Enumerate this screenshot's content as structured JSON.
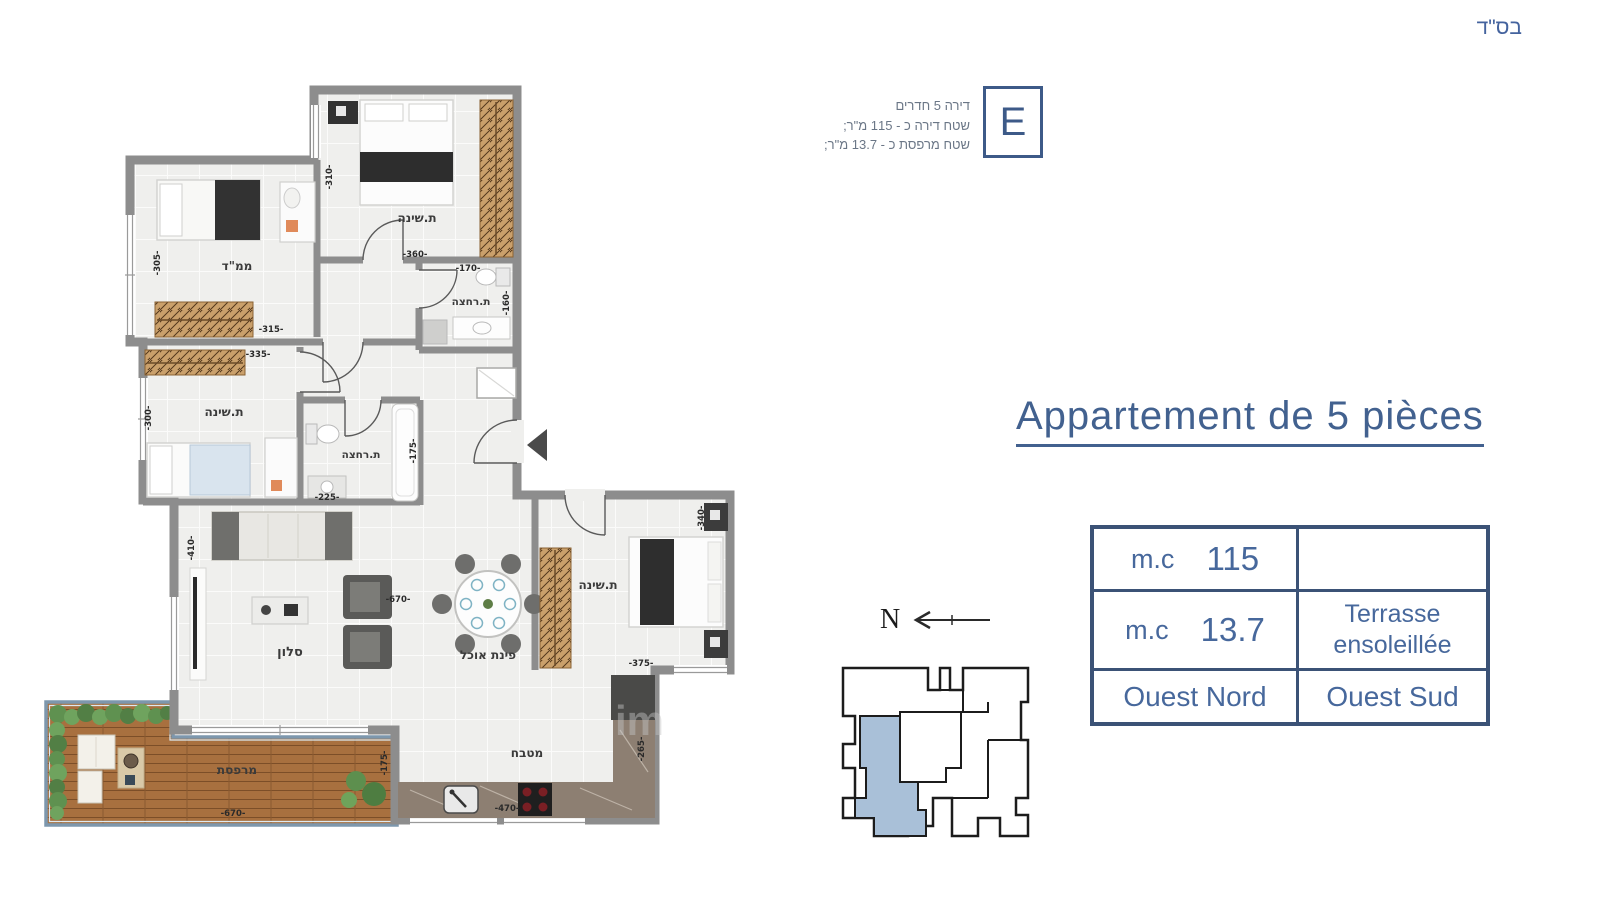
{
  "page": {
    "bsd": "בס\"ד"
  },
  "unit_info": {
    "line1": "דירה 5 חדרים",
    "line2": "שטח דירה כ - 115 מ\"ר;",
    "line3": "שטח מרפסת כ - 13.7 מ\"ר;",
    "unit_letter": "E"
  },
  "title": "Appartement de 5 pièces",
  "spec_table": {
    "r1c1_label": "m.c",
    "r1c1_value": "115",
    "r1c2": "",
    "r2c1_label": "m.c",
    "r2c1_value": "13.7",
    "r2c2_line1": "Terrasse",
    "r2c2_line2": "ensoleillée",
    "r3c1": "Ouest Nord",
    "r3c2": "Ouest Sud"
  },
  "compass": {
    "north_label": "N"
  },
  "floor_plan": {
    "room_labels": {
      "bedroom_top": "ת.שינה",
      "mamad": "ממ\"ד",
      "bath_top": "ת.רחצה",
      "bedroom_left": "ת.שינה",
      "bath_mid": "ת.רחצה",
      "living": "סלון",
      "dining": "פינת אוכל",
      "bedroom_right": "ת.שינה",
      "kitchen": "מטבח",
      "terrace": "מרפסת"
    },
    "dimensions": {
      "br1_w": "-360-",
      "br1_h": "-310-",
      "mamad_w": "-315-",
      "mamad_h": "-305-",
      "bath1_w": "-170-",
      "bath1_h": "-160-",
      "br2_w": "-335-",
      "br2_h": "-300-",
      "bath2_w": "-225-",
      "bath2_h": "-175-",
      "living_w": "-670-",
      "living_h": "-410-",
      "br3_w": "-375-",
      "br3_h": "-340-",
      "kitchen_w": "-470-",
      "kitchen_h": "-265-",
      "terrace_w": "-670-",
      "terrace_h": "-175-"
    },
    "watermark": "im"
  },
  "colors": {
    "accent_blue": "#42618f",
    "table_border": "#3b5276",
    "wall_gray": "#8d8d8d",
    "keyplan_highlight": "#a9c0d8"
  }
}
